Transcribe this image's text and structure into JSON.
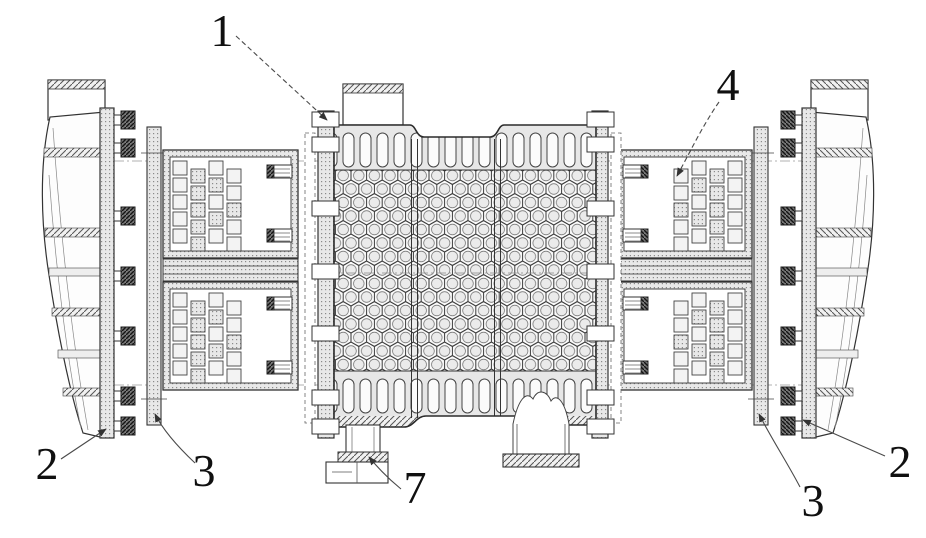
{
  "figure": {
    "callouts": {
      "c1": "1",
      "c2_left": "2",
      "c3_left": "3",
      "c4": "4",
      "c7": "7",
      "c3_right": "3",
      "c2_right": "2"
    },
    "colors": {
      "background": "#ffffff",
      "line": "#2b2b2b",
      "shade_light": "#e9e9e9",
      "bolt_dark": "#6f6f6f"
    }
  }
}
